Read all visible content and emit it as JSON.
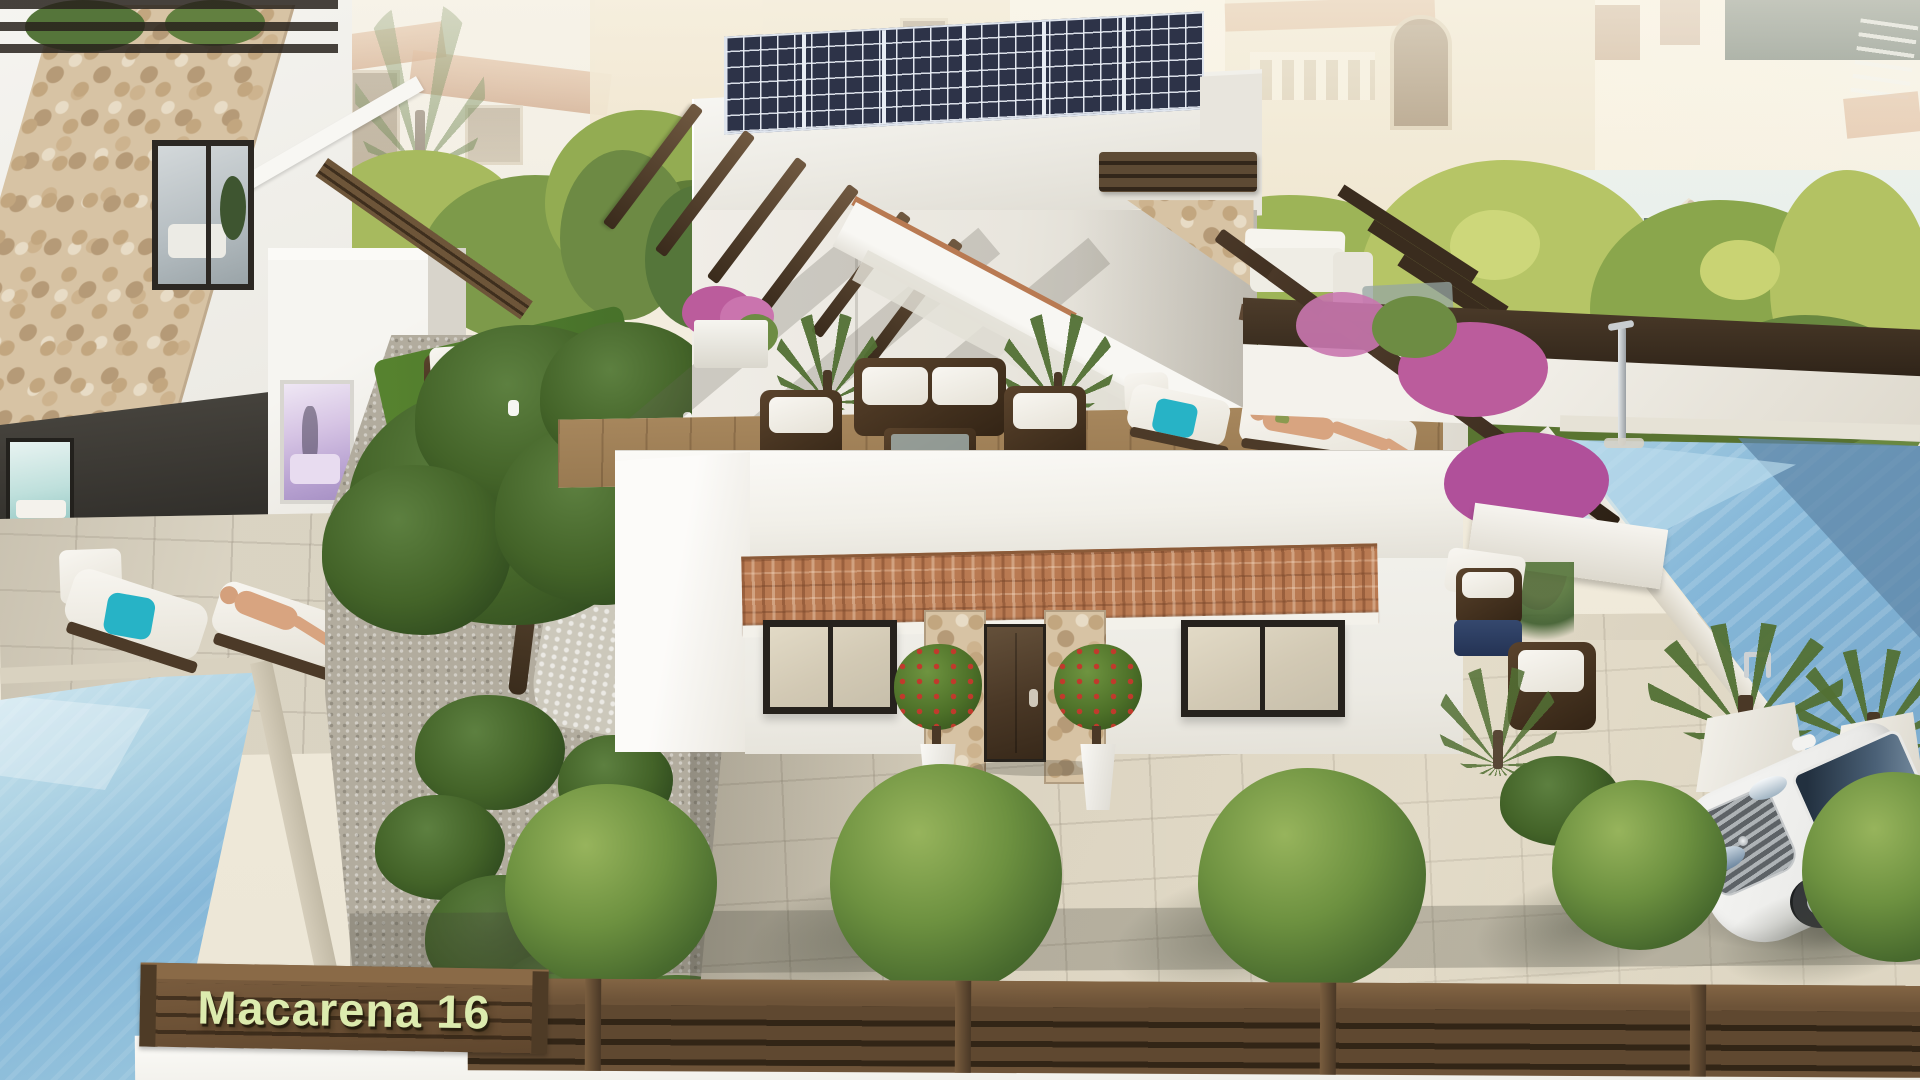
{
  "scene": {
    "type": "3d-architectural-render",
    "development_name": "Macarena 16",
    "description": "Aerial 3D rendering of a modern white Mediterranean villa with rooftop solar panels, roof terrace with rattan lounge furniture, sun loungers with sunbathers, terracotta tile entrance awning, two swimming pools, landscaped garden with round bushes, a white car parked beside the pool, and a brown slatted street fence bearing the development name.",
    "key_elements": [
      "solar-panel-roof",
      "roof-terrace-lounge",
      "pergola-beams",
      "sun-loungers",
      "front-door",
      "terracotta-awning",
      "topiary-trees",
      "right-swimming-pool",
      "left-swimming-pool",
      "bougainvillea-pergola",
      "white-car",
      "garden-bushes",
      "street-fence",
      "name-sign",
      "background-village-houses"
    ]
  },
  "sign": {
    "text": "Macarena 16"
  },
  "colors": {
    "sky": "#f6f2e6",
    "wall_white": "#f3f2ed",
    "wall_shadow": "#d9d5cc",
    "terracotta_roof": "#b97a52",
    "solar_panel": "#2d3348",
    "pool_water": "#85b7d8",
    "pergola_wood": "#4a3a2a",
    "fence_wood": "#6d5338",
    "sign_text": "#dcebae",
    "foliage_dark": "#3f5e2a",
    "foliage_light": "#9fb85a",
    "bougainvillea": "#bb5c9c",
    "paving": "#d8d0bd",
    "teal_cushion": "#27b3c6",
    "car_body": "#f2f2f0"
  }
}
